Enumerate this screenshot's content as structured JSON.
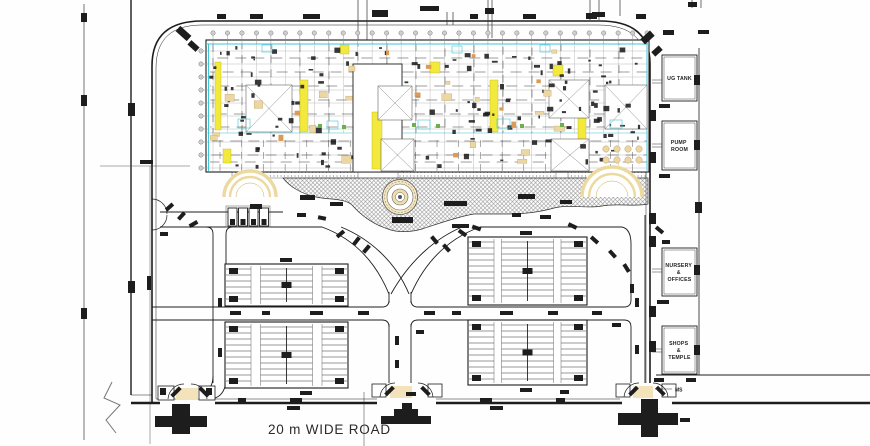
{
  "plan": {
    "road_label": "20 m WIDE ROAD",
    "gate_label": "MS",
    "side_buildings": [
      {
        "id": "ug-tank",
        "lines": [
          "UG TANK"
        ]
      },
      {
        "id": "pump-room",
        "lines": [
          "PUMP",
          "ROOM"
        ]
      },
      {
        "id": "nursery-offices",
        "lines": [
          "NURSERY",
          "&",
          "OFFICES"
        ]
      },
      {
        "id": "shops-temple",
        "lines": [
          "SHOPS",
          "&",
          "TEMPLE"
        ]
      }
    ],
    "colors": {
      "ink": "#1d1d1d",
      "cyan": "#3fc6d8",
      "grid": "#ababab",
      "yellow": "#f3e93c",
      "tan": "#ecd7a4",
      "canopy": "#ecd9a0",
      "orange": "#dc9a55",
      "hatch": "#8f8f8f",
      "green": "#6fae4e",
      "paper": "#fefefe"
    }
  }
}
